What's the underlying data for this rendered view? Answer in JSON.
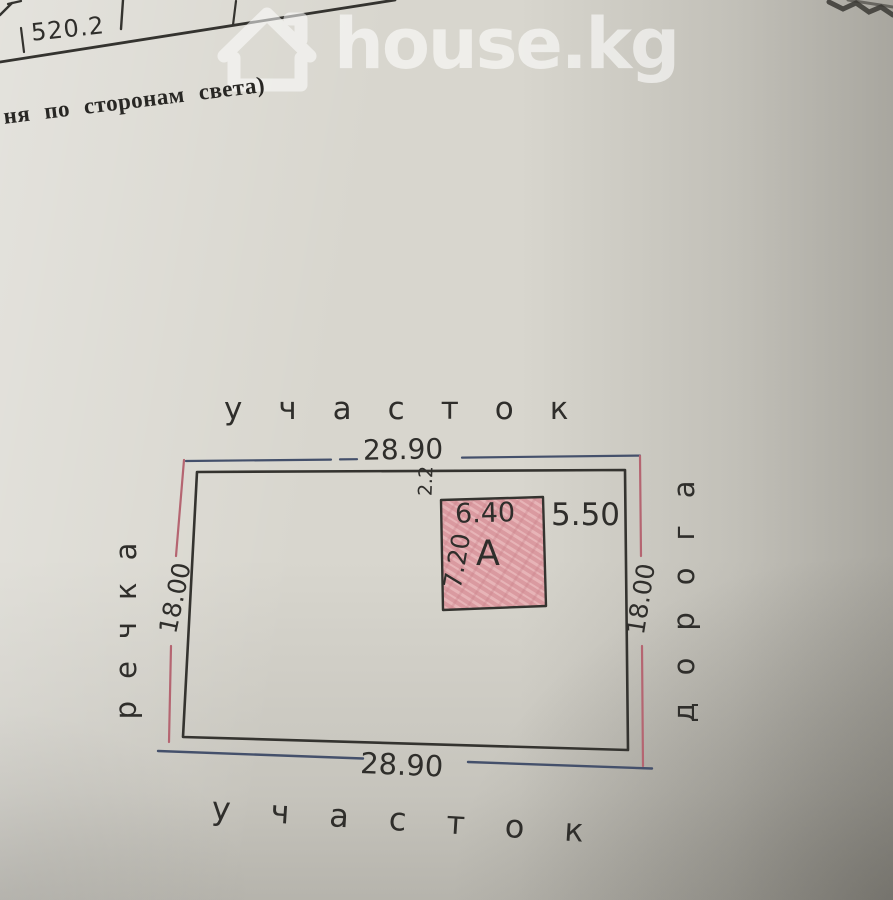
{
  "colors": {
    "paper": "#d8d6ce",
    "ink": "#34332f",
    "dimension_blue": "#44506b",
    "dimension_pink": "#b56571",
    "building_fill": "#e3abaf",
    "watermark": "#ffffff"
  },
  "table_fragment": {
    "area_value": "520.2"
  },
  "caption": {
    "text": "ня по сторонам света)"
  },
  "watermark": {
    "brand": "house.kg",
    "icon": "house-icon"
  },
  "site_plan": {
    "north_label": "участок",
    "south_label": "участок",
    "west_label": "речка",
    "east_label": "дорога",
    "dimensions": {
      "top": "28.90",
      "bottom": "28.90",
      "left": "18.00",
      "right": "18.00"
    },
    "building": {
      "designation": "А",
      "width": "6.40",
      "depth": "7.20",
      "gap_right": "5.50",
      "gap_top": "2.2"
    }
  }
}
